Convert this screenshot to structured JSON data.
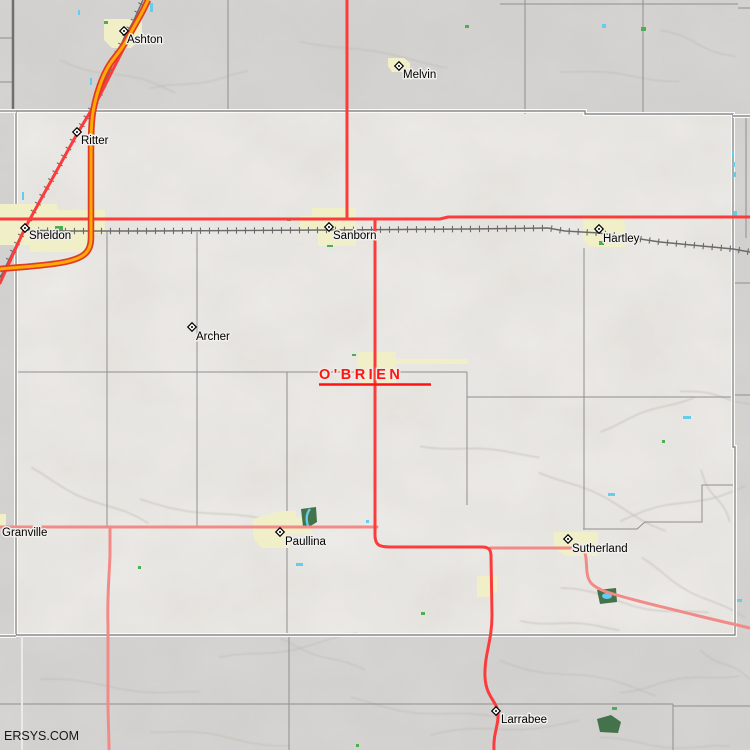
{
  "map": {
    "county_label": {
      "text": "O'BRIEN",
      "x": 319,
      "y": 379,
      "underline": "M319,384.5 H431",
      "color": "#ff1212"
    },
    "watermark": {
      "text": "ERSYS.COM",
      "x": 4,
      "y": 740
    },
    "colors": {
      "outside": "#d6d5d3",
      "inside": "#edebe7",
      "township_line": "#8f8f8f",
      "thick_line": "#6f6f6f",
      "county_line": "#8a8a8a",
      "county_casing": "#fafaf9",
      "town_area": "#f1efc8",
      "park": "#44724a",
      "speck_green": "#4fae54",
      "water": "#66ccee",
      "pink_road": "#f28b87",
      "red_road": "#fb3c3c",
      "orange_fill": "#ffaa00",
      "orange_casing": "#e03b28",
      "rail": "#6b6b6b"
    },
    "towns": [
      {
        "name": "Ashton",
        "marker": [
          124,
          31
        ],
        "label": [
          127,
          43
        ]
      },
      {
        "name": "Melvin",
        "marker": [
          399,
          66
        ],
        "label": [
          403,
          78
        ]
      },
      {
        "name": "Ritter",
        "marker": [
          77,
          132
        ],
        "label": [
          81,
          144
        ]
      },
      {
        "name": "Sheldon",
        "marker": [
          25,
          228
        ],
        "label": [
          29,
          239
        ]
      },
      {
        "name": "Sanborn",
        "marker": [
          329,
          227
        ],
        "label": [
          333,
          239
        ]
      },
      {
        "name": "Hartley",
        "marker": [
          599,
          229
        ],
        "label": [
          603,
          242
        ]
      },
      {
        "name": "Archer",
        "marker": [
          192,
          327
        ],
        "label": [
          196,
          340
        ]
      },
      {
        "name": "Granville",
        "marker": null,
        "label": [
          2,
          536
        ]
      },
      {
        "name": "Paullina",
        "marker": [
          280,
          532
        ],
        "label": [
          285,
          545
        ]
      },
      {
        "name": "Sutherland",
        "marker": [
          568,
          539
        ],
        "label": [
          572,
          552
        ]
      },
      {
        "name": "Larrabee",
        "marker": [
          496,
          711
        ],
        "label": [
          501,
          723
        ]
      }
    ],
    "town_areas": [
      {
        "name": "ashton",
        "pts": [
          [
            104,
            19
          ],
          [
            142,
            19
          ],
          [
            142,
            38
          ],
          [
            131,
            48
          ],
          [
            112,
            48
          ],
          [
            104,
            40
          ]
        ]
      },
      {
        "name": "melvin",
        "pts": [
          [
            388,
            58
          ],
          [
            404,
            58
          ],
          [
            410,
            63
          ],
          [
            410,
            72
          ],
          [
            392,
            72
          ],
          [
            388,
            66
          ]
        ]
      },
      {
        "name": "sheldon",
        "pts": [
          [
            0,
            204
          ],
          [
            57,
            204
          ],
          [
            57,
            210
          ],
          [
            105,
            210
          ],
          [
            105,
            233
          ],
          [
            88,
            233
          ],
          [
            88,
            252
          ],
          [
            30,
            252
          ],
          [
            30,
            245
          ],
          [
            0,
            245
          ]
        ]
      },
      {
        "name": "sanborn",
        "pts": [
          [
            312,
            208
          ],
          [
            356,
            208
          ],
          [
            356,
            246
          ],
          [
            318,
            246
          ],
          [
            318,
            232
          ],
          [
            300,
            232
          ],
          [
            300,
            216
          ],
          [
            312,
            216
          ]
        ]
      },
      {
        "name": "hartley",
        "pts": [
          [
            583,
            217
          ],
          [
            620,
            217
          ],
          [
            625,
            222
          ],
          [
            625,
            247
          ],
          [
            590,
            247
          ],
          [
            583,
            240
          ]
        ]
      },
      {
        "name": "primghar",
        "pts": [
          [
            358,
            352
          ],
          [
            396,
            352
          ],
          [
            396,
            359
          ],
          [
            468,
            359
          ],
          [
            468,
            364
          ],
          [
            396,
            364
          ],
          [
            396,
            384
          ],
          [
            362,
            384
          ],
          [
            358,
            376
          ]
        ]
      },
      {
        "name": "paullina",
        "pts": [
          [
            253,
            519
          ],
          [
            270,
            514
          ],
          [
            282,
            511
          ],
          [
            296,
            511
          ],
          [
            296,
            517
          ],
          [
            312,
            517
          ],
          [
            312,
            534
          ],
          [
            290,
            534
          ],
          [
            290,
            548
          ],
          [
            262,
            548
          ],
          [
            255,
            541
          ],
          [
            253,
            534
          ]
        ]
      },
      {
        "name": "sutherland",
        "pts": [
          [
            554,
            532
          ],
          [
            598,
            532
          ],
          [
            598,
            556
          ],
          [
            566,
            556
          ],
          [
            554,
            548
          ]
        ]
      },
      {
        "name": "granville",
        "pts": [
          [
            0,
            514
          ],
          [
            6,
            514
          ],
          [
            6,
            526
          ],
          [
            0,
            526
          ]
        ]
      },
      {
        "name": "calumet",
        "pts": [
          [
            477,
            576
          ],
          [
            497,
            576
          ],
          [
            497,
            591
          ],
          [
            490,
            597
          ],
          [
            477,
            597
          ]
        ]
      }
    ],
    "parks": [
      {
        "name": "paullina-park",
        "pts": [
          [
            301,
            509
          ],
          [
            316,
            507
          ],
          [
            317,
            522
          ],
          [
            309,
            527
          ],
          [
            303,
            527
          ]
        ]
      },
      {
        "name": "sutherland-park",
        "pts": [
          [
            597,
            590
          ],
          [
            616,
            588
          ],
          [
            617,
            602
          ],
          [
            600,
            604
          ]
        ]
      },
      {
        "name": "larrabee-woods",
        "pts": [
          [
            597,
            719
          ],
          [
            611,
            715
          ],
          [
            621,
            722
          ],
          [
            618,
            733
          ],
          [
            600,
            732
          ]
        ]
      }
    ],
    "park_water": [
      {
        "type": "path",
        "d": "M310,509 C306,514 306,520 308,526",
        "w": 2.4
      },
      {
        "type": "ellipse",
        "cx": 607,
        "cy": 596,
        "rx": 5,
        "ry": 3
      }
    ],
    "green_specks": [
      [
        104,
        21,
        4,
        3
      ],
      [
        55,
        226,
        8,
        6
      ],
      [
        287,
        218,
        4,
        3
      ],
      [
        327,
        245,
        6,
        2
      ],
      [
        352,
        354,
        4,
        2
      ],
      [
        465,
        25,
        4,
        3
      ],
      [
        641,
        27,
        5,
        4
      ],
      [
        599,
        241,
        5,
        4
      ],
      [
        138,
        566,
        3,
        3
      ],
      [
        421,
        612,
        4,
        3
      ],
      [
        356,
        744,
        3,
        3
      ],
      [
        662,
        440,
        3,
        3
      ],
      [
        612,
        707,
        5,
        3
      ]
    ],
    "water_specks": [
      [
        150,
        3,
        3,
        9
      ],
      [
        90,
        78,
        2,
        7
      ],
      [
        22,
        192,
        2,
        8
      ],
      [
        78,
        10,
        2,
        5
      ],
      [
        602,
        24,
        4,
        4
      ],
      [
        732,
        151,
        2,
        6
      ],
      [
        733,
        162,
        2,
        5
      ],
      [
        734,
        172,
        2,
        5
      ],
      [
        734,
        211,
        3,
        6
      ],
      [
        683,
        416,
        8,
        3
      ],
      [
        296,
        563,
        7,
        3
      ],
      [
        366,
        520,
        3,
        3
      ],
      [
        608,
        493,
        7,
        3
      ],
      [
        737,
        599,
        5,
        3
      ]
    ],
    "railroads": [
      [
        [
          143,
          0
        ],
        [
          133,
          22
        ],
        [
          124,
          38
        ],
        [
          98,
          98
        ],
        [
          77,
          133
        ],
        [
          25,
          227
        ],
        [
          0,
          278
        ]
      ],
      [
        [
          25,
          230
        ],
        [
          60,
          231
        ],
        [
          150,
          231
        ],
        [
          328,
          230
        ],
        [
          470,
          229
        ],
        [
          548,
          228
        ],
        [
          565,
          231
        ],
        [
          599,
          233
        ],
        [
          620,
          236
        ],
        [
          660,
          242
        ],
        [
          733,
          249
        ],
        [
          750,
          252
        ]
      ]
    ],
    "roads": {
      "red": [
        "M0,219 L440,219 L448,217 L750,217",
        "M347,0 L347,219",
        "M375,219 L375,535 C375,545 379,547 390,547 L482,547 C489,547 491,550 491,556 L492,615 C492,642 484,655 485,677 C486,697 497,701 498,713 C499,725 493,733 494,750",
        "M129,38 L98,99 L77,134 L25,228 L0,283"
      ],
      "pink": [
        "M0,527 L377,527",
        "M110,527 L110,555 C109,580 107,600 108,625 L108,700 C108,720 109,735 109,750",
        "M490,548 L578,548 C584,548 585,552 586,558 L587,572 C588,582 592,586 604,591 C630,600 660,606 695,615 C715,620 733,624 750,628"
      ],
      "orange": [
        "M148,0 C142,14 134,26 129,36 C122,50 116,55 110,64 C102,76 96,95 93,112 C91,124 91,140 91,160 L91,238 C91,252 84,258 65,262 C45,266 20,267 0,269"
      ]
    },
    "admin": {
      "thick": [
        "M13,0 V111"
      ],
      "township": [
        "M228,0 V111",
        "M525,0 V114",
        "M643,0 V114",
        "M500,4 H738",
        "M738,8 H750",
        "M0,38 H13",
        "M0,82 H13",
        "M107,232 V527",
        "M197,232 V527",
        "M287,372 V635",
        "M289,636 V750",
        "M467,372 V505",
        "M584,248 V529",
        "M16,372 H467",
        "M467,397 H733",
        "M733,395 H750",
        "M583,529 H637 L645,522 H702 V485 H733",
        "M0,704 H673",
        "M673,706 H750",
        "M673,704 V750",
        "M746,115 V238",
        "M733,283 H750"
      ],
      "county": [
        "M16,111 H585 V114 H733 V447 H735 V635 H16 Z",
        "M0,111 H16",
        "M0,636 H16",
        "M733,116 H750"
      ],
      "white_line": [
        "M22,636 V750"
      ]
    }
  }
}
